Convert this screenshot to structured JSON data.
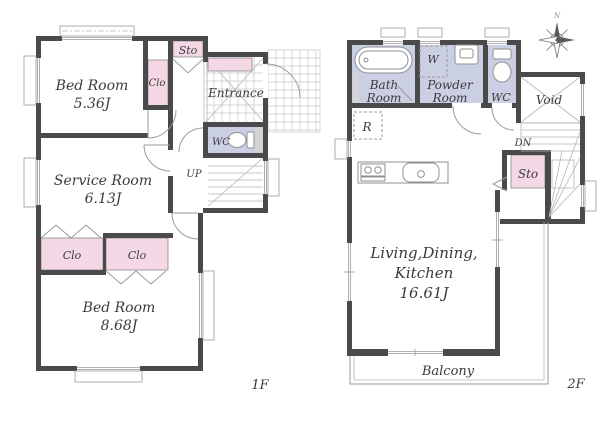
{
  "floor1": {
    "floor_label": "1F",
    "bedroom1": {
      "name": "Bed Room",
      "area": "5.36J"
    },
    "service_room": {
      "name": "Service Room",
      "area": "6.13J"
    },
    "bedroom2": {
      "name": "Bed Room",
      "area": "8.68J"
    },
    "closet_bedroom1": "Clo",
    "closet_left": "Clo",
    "closet_right": "Clo",
    "storage": "Sto",
    "entrance": "Entrance",
    "wc": "WC",
    "stairs_up": "UP"
  },
  "floor2": {
    "floor_label": "2F",
    "bath_room": {
      "line1": "Bath",
      "line2": "Room"
    },
    "powder_room": {
      "line1": "Powder",
      "line2": "Room"
    },
    "washer": "W",
    "wc": "WC",
    "void": "Void",
    "stairs_down": "DN",
    "storage": "Sto",
    "refrigerator": "R",
    "ldk": {
      "line1": "Living,Dining,",
      "line2": "Kitchen",
      "area": "16.61J"
    },
    "balcony": "Balcony"
  },
  "compass": {
    "north_label": "N"
  },
  "colors": {
    "wall": "#4a4a4a",
    "closet_pink": "#f5d8e6",
    "wet_area_lavender": "#cbcfe3",
    "line_gray": "#9a9a9a",
    "text": "#3b3b3b"
  }
}
